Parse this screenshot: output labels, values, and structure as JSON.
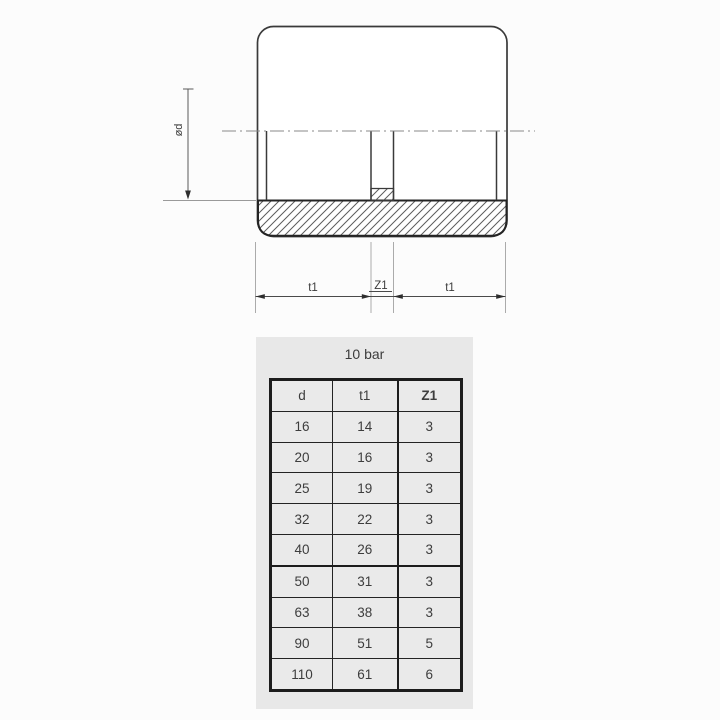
{
  "drawing": {
    "labels": {
      "diameter": "ød",
      "t1": "t1",
      "z1": "Z1"
    }
  },
  "panel": {
    "title": "10 bar"
  },
  "table": {
    "columns": [
      "d",
      "t1",
      "Z1"
    ],
    "rows": [
      [
        "16",
        "14",
        "3"
      ],
      [
        "20",
        "16",
        "3"
      ],
      [
        "25",
        "19",
        "3"
      ],
      [
        "32",
        "22",
        "3"
      ],
      [
        "40",
        "26",
        "3"
      ],
      [
        "50",
        "31",
        "3"
      ],
      [
        "63",
        "38",
        "3"
      ],
      [
        "90",
        "51",
        "5"
      ],
      [
        "110",
        "61",
        "6"
      ]
    ]
  },
  "colors": {
    "page_bg": "#fcfcfc",
    "panel_bg": "#e8e8e8",
    "cell_bg": "#eaeaea",
    "drawing_line": "#3a3a3a",
    "table_border": "#1c1c1c",
    "text": "#3d3d3d"
  }
}
